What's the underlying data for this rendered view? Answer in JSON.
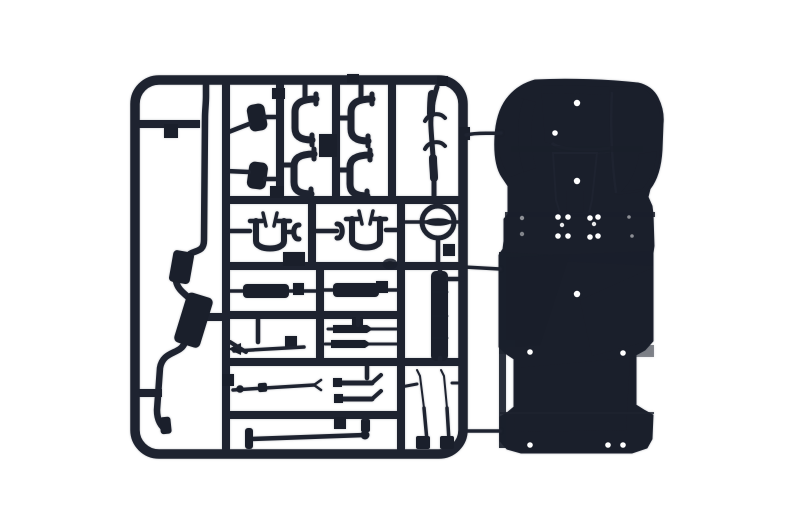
{
  "scene": {
    "type": "product photograph",
    "alt": "Black plastic model kit sprue with chassis and suspension parts beside a one-piece chassis floor pan on a white background",
    "background_color": "#ffffff"
  },
  "palette": {
    "sprue": "#1e2330",
    "sprue_part": "#1a1f2b",
    "gate_mark": "#8b8577",
    "gate_mark_core": "#6e6a5e",
    "chassis_base": "#14171d",
    "chassis_edge": "#272c36",
    "chassis_panel": "#20242c",
    "chassis_panel_lip": "#0f1218",
    "arch_left": "#262b34",
    "arch_left_shadow": "#0f1218",
    "arch_right": "#1f232b",
    "arch_highlight": "#3a3f47",
    "shadow_band": "#0d1015",
    "tunnel": "#232831",
    "tunnel_notch": "#11141a",
    "blue_sheen": "#28334e",
    "step_shadow": "#1a2030",
    "bed_sheen_1": "#1c212b",
    "bed_sheen_2": "#1b202a",
    "bed_sheen_3": "#191e27",
    "bed_side_sliver": "#1e232c",
    "hole": "#ffffff"
  },
  "sprue": {
    "name": "parts sprue",
    "parts": [
      "exhaust pipe with muffler",
      "mounting blocks",
      "c-shaped brackets",
      "gear lever rod",
      "u-shaped axle mounts",
      "steering wheel",
      "leaf springs",
      "drive shafts",
      "side rail",
      "tie rods",
      "wiper blades",
      "front axle"
    ]
  },
  "chassis": {
    "name": "chassis floor pan",
    "features": [
      "cab floor",
      "left wheel arch",
      "right wheel arch",
      "transmission tunnel",
      "cargo bed",
      "axle notches"
    ],
    "ejector_pin_holes": [
      {
        "x": 577,
        "y": 103,
        "r": 3.2,
        "o": 1
      },
      {
        "x": 555,
        "y": 133,
        "r": 2.8,
        "o": 1
      },
      {
        "x": 577,
        "y": 181,
        "r": 3.2,
        "o": 1
      },
      {
        "x": 522,
        "y": 218,
        "r": 2.2,
        "o": 0.5
      },
      {
        "x": 522,
        "y": 234,
        "r": 2.2,
        "o": 0.45
      },
      {
        "x": 558,
        "y": 217,
        "r": 2.8,
        "o": 1
      },
      {
        "x": 568,
        "y": 217,
        "r": 2.8,
        "o": 1
      },
      {
        "x": 590,
        "y": 218,
        "r": 2.8,
        "o": 1
      },
      {
        "x": 598,
        "y": 217,
        "r": 2.8,
        "o": 1
      },
      {
        "x": 562,
        "y": 225,
        "r": 2.2,
        "o": 0.9
      },
      {
        "x": 594,
        "y": 224,
        "r": 2.2,
        "o": 0.9
      },
      {
        "x": 558,
        "y": 236,
        "r": 2.8,
        "o": 1
      },
      {
        "x": 568,
        "y": 236,
        "r": 2.8,
        "o": 1
      },
      {
        "x": 590,
        "y": 237,
        "r": 2.8,
        "o": 1
      },
      {
        "x": 598,
        "y": 236,
        "r": 2.8,
        "o": 1
      },
      {
        "x": 629,
        "y": 217,
        "r": 1.8,
        "o": 0.5
      },
      {
        "x": 632,
        "y": 236,
        "r": 1.8,
        "o": 0.5
      },
      {
        "x": 577,
        "y": 294,
        "r": 3.2,
        "o": 1
      },
      {
        "x": 530,
        "y": 352,
        "r": 2.8,
        "o": 1
      },
      {
        "x": 623,
        "y": 353,
        "r": 2.8,
        "o": 1
      },
      {
        "x": 530,
        "y": 445,
        "r": 2.8,
        "o": 1
      },
      {
        "x": 608,
        "y": 445,
        "r": 2.8,
        "o": 1
      },
      {
        "x": 623,
        "y": 445,
        "r": 2.8,
        "o": 1
      }
    ]
  }
}
